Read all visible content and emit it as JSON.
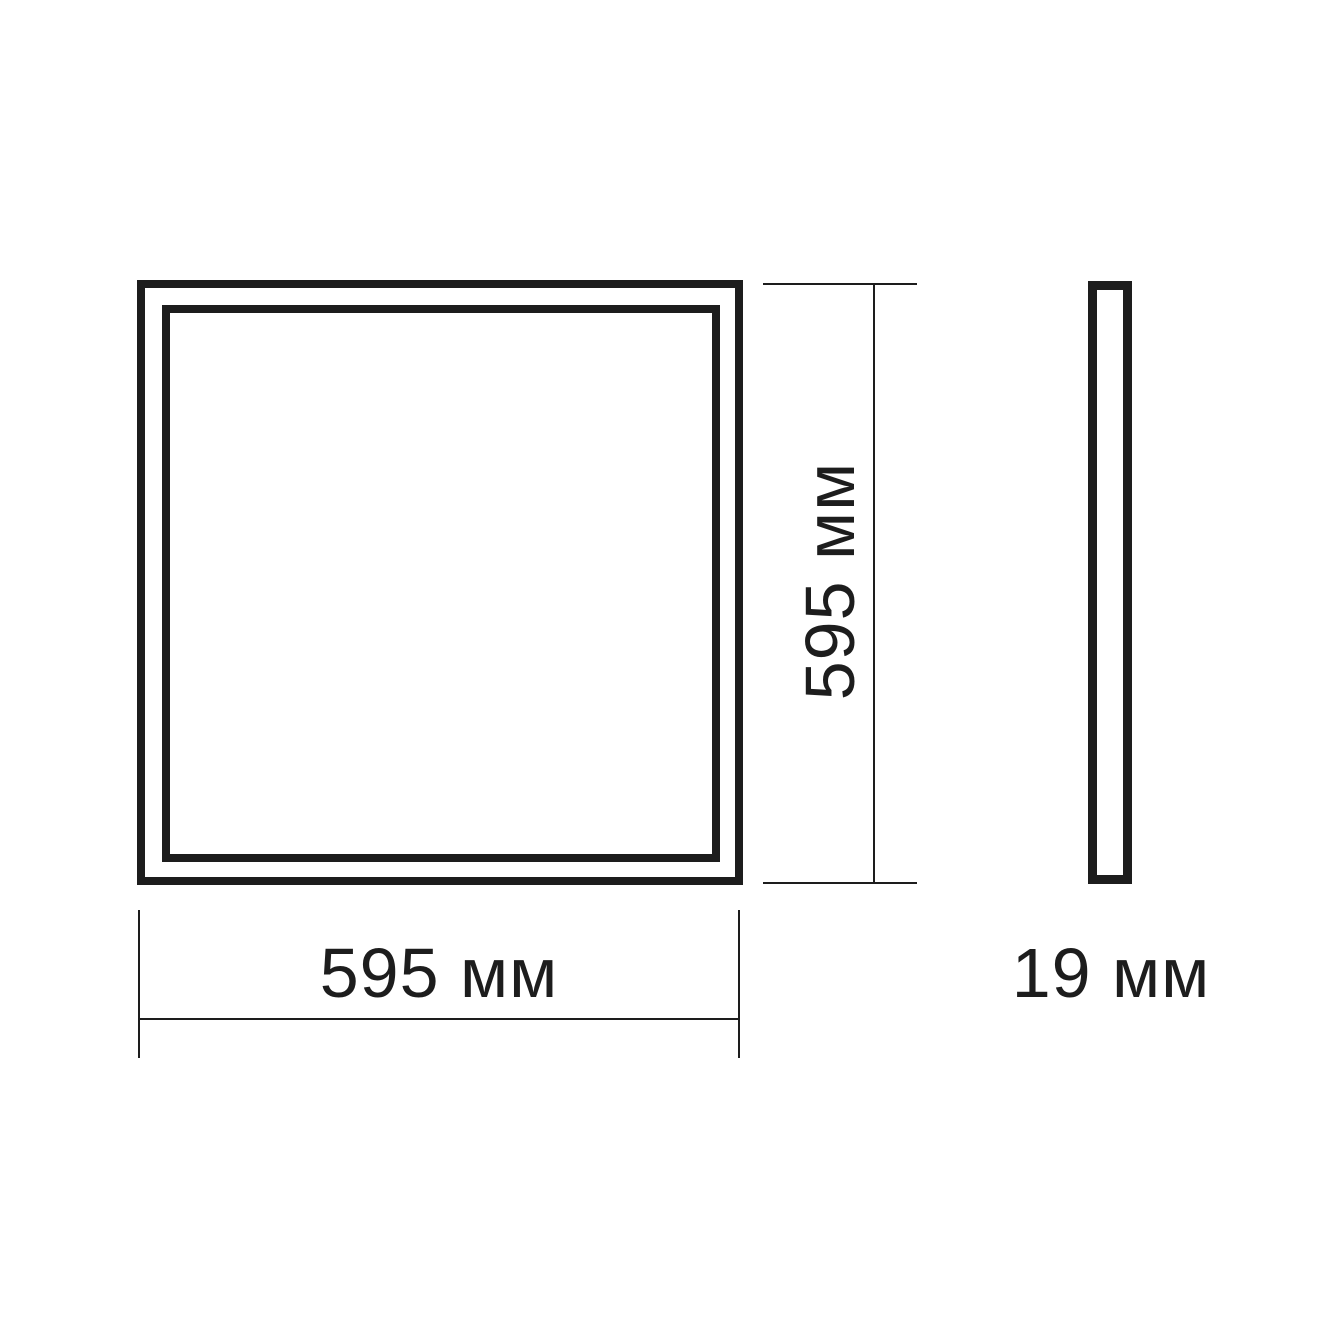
{
  "diagram": {
    "type": "dimensional-drawing",
    "front_view": {
      "width_label": "595 мм",
      "height_label": "595 мм",
      "width_mm": 595,
      "height_mm": 595
    },
    "side_view": {
      "depth_label": "19 мм",
      "depth_mm": 19
    },
    "colors": {
      "line": "#1d1d1d",
      "background": "#ffffff"
    }
  }
}
